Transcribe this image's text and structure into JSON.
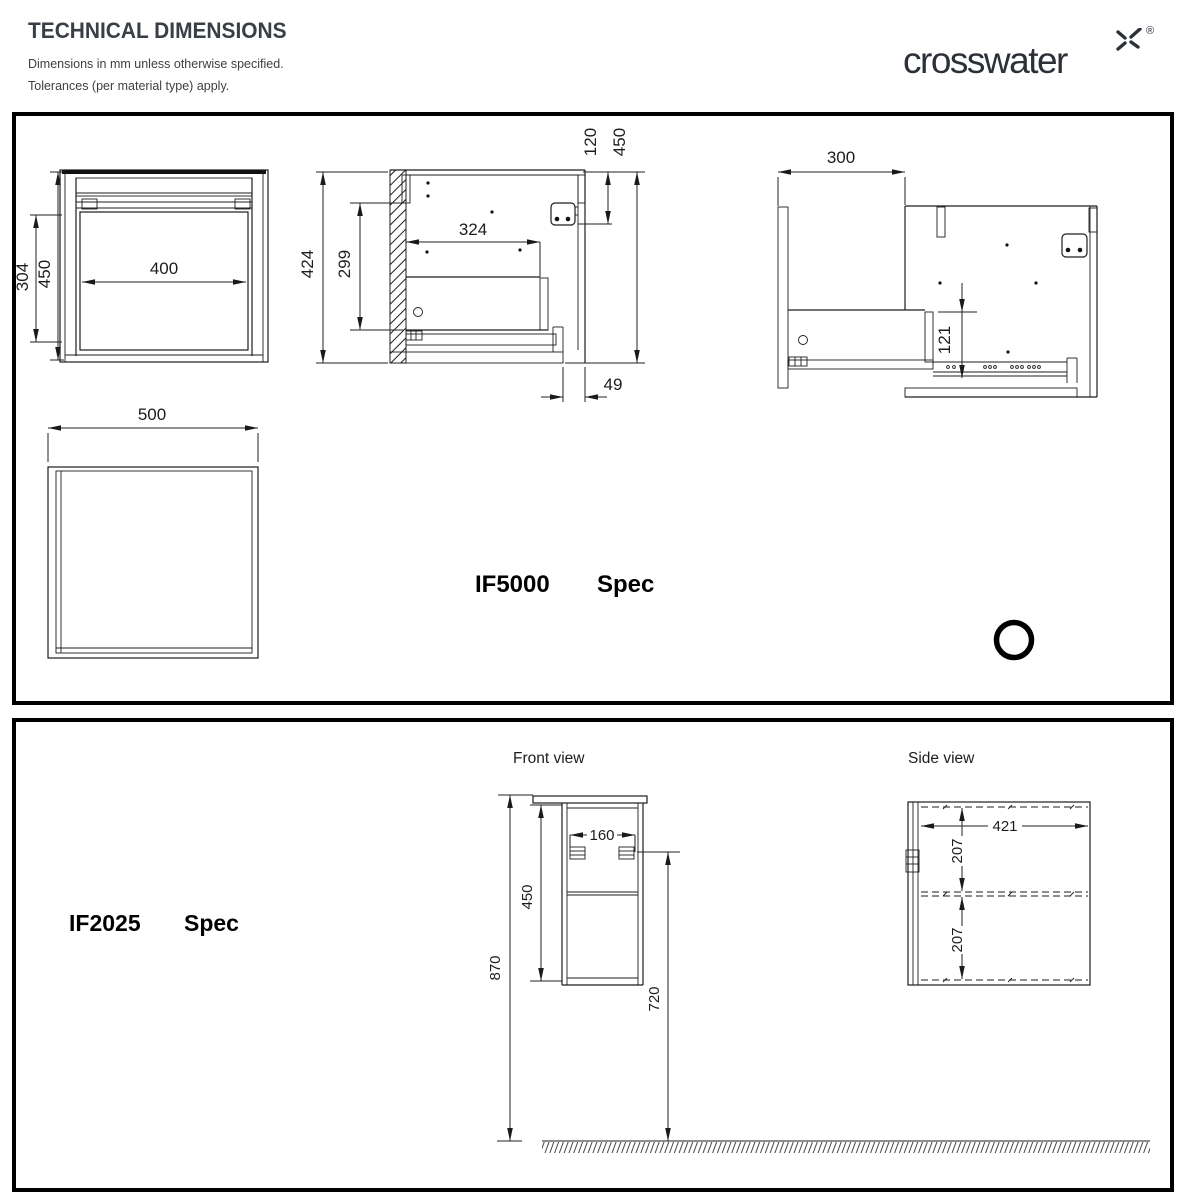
{
  "header": {
    "title": "TECHNICAL DIMENSIONS",
    "subtitle1": "Dimensions in mm unless otherwise specified.",
    "subtitle2": "Tolerances (per material type) apply.",
    "brand": "crosswater",
    "registered_mark": "®"
  },
  "if5000": {
    "model": "IF5000",
    "spec": "Spec",
    "front_view": {
      "width": "400",
      "opening_height": "304",
      "height": "450"
    },
    "side_section": {
      "height": "424",
      "inner_height": "299",
      "depth": "324",
      "hinge_offset": "120",
      "overall_height": "450",
      "bottom_offset": "49"
    },
    "side_open": {
      "wall_to_front": "300",
      "rail_height": "121"
    },
    "plan_view": {
      "width": "500"
    }
  },
  "if2025": {
    "model": "IF2025",
    "spec": "Spec",
    "front_view_label": "Front view",
    "side_view_label": "Side view",
    "front_view": {
      "bracket_spacing": "160",
      "cabinet_height": "450",
      "overall_height": "870",
      "floor_clearance": "720"
    },
    "side_view": {
      "depth": "421",
      "top_section": "207",
      "bottom_section": "207"
    }
  }
}
